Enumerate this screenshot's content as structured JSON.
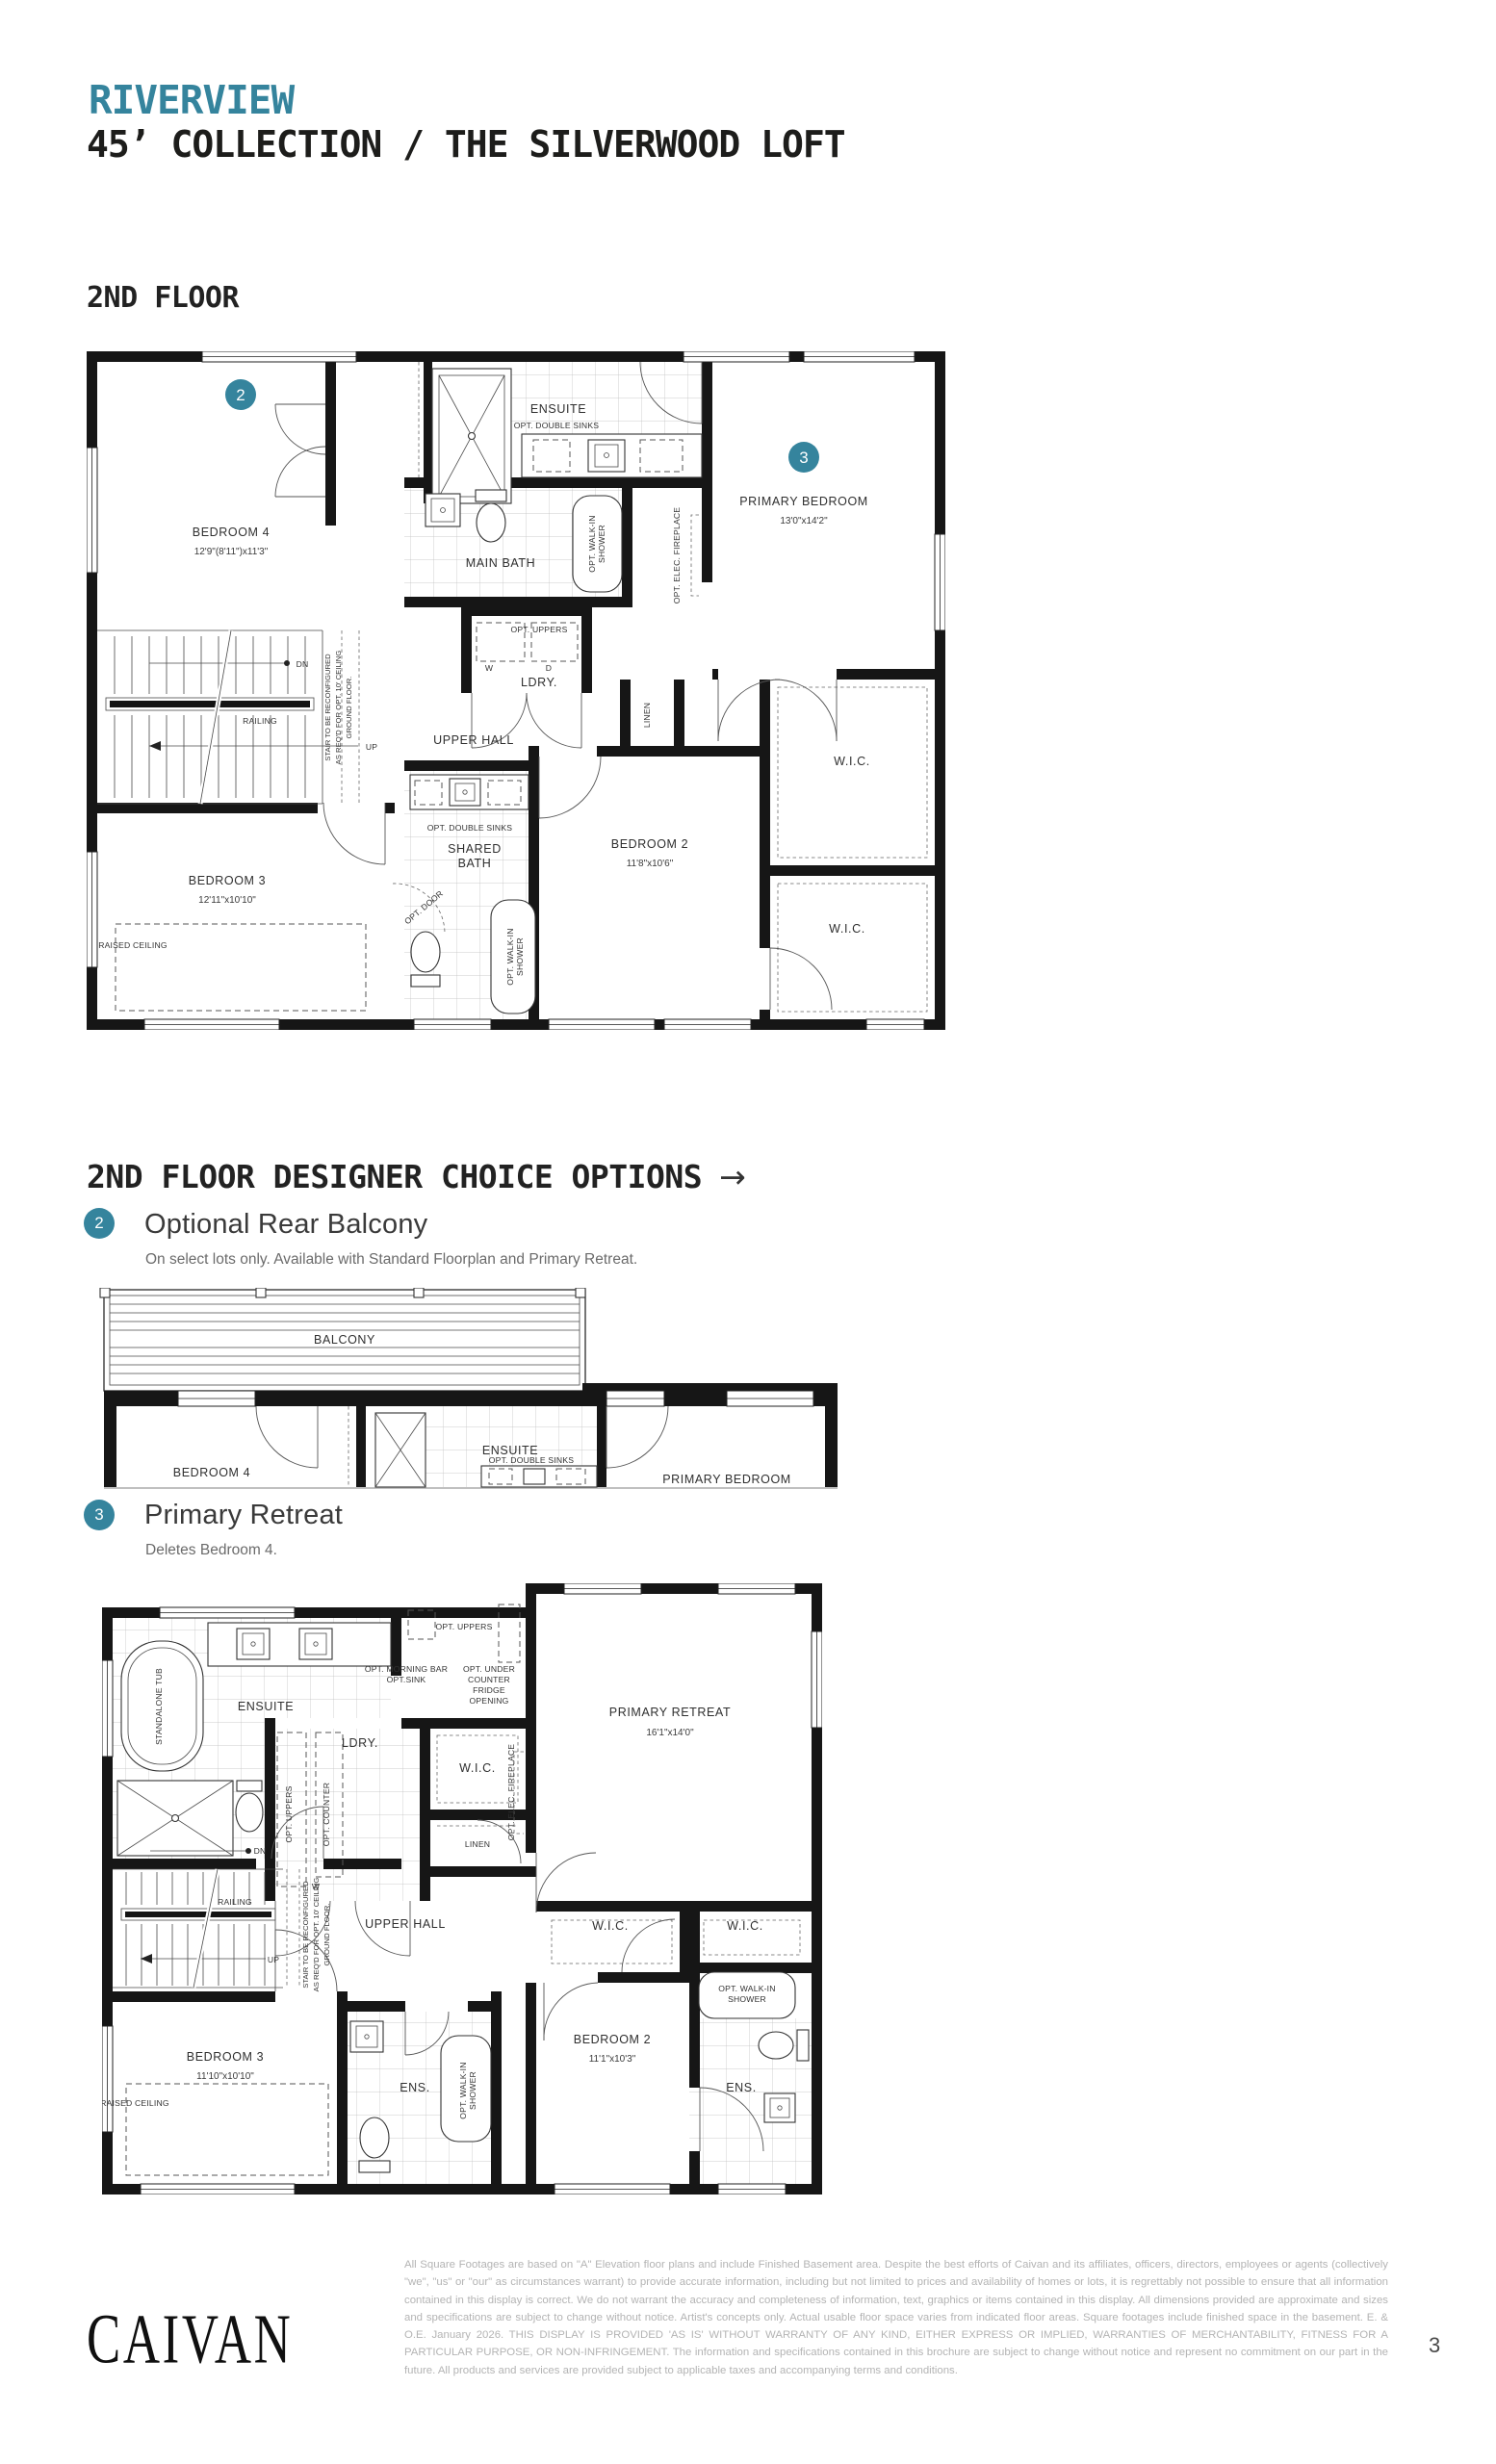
{
  "accent_color": "#35849d",
  "header": {
    "community": "RIVERVIEW",
    "title": "45’ COLLECTION / THE SILVERWOOD LOFT"
  },
  "sections": {
    "floor_heading": "2ND FLOOR",
    "options_heading": "2ND FLOOR DESIGNER CHOICE OPTIONS",
    "options_arrow": "→"
  },
  "options": [
    {
      "number": "2",
      "title": "Optional Rear Balcony",
      "description": "On select lots only. Available with Standard Floorplan and Primary Retreat."
    },
    {
      "number": "3",
      "title": "Primary Retreat",
      "description": "Deletes Bedroom 4."
    }
  ],
  "main_plan": {
    "marker2": "2",
    "marker3": "3",
    "bedroom4": {
      "name": "BEDROOM 4",
      "dims": "12'9\"(8'11\")x11'3\""
    },
    "ensuite": "ENSUITE",
    "opt_double_sinks": "OPT. DOUBLE SINKS",
    "main_bath": "MAIN BATH",
    "opt_walkin_shower_lines": [
      "OPT. WALK-IN",
      "SHOWER"
    ],
    "primary_bedroom": {
      "name": "PRIMARY BEDROOM",
      "dims": "13'0\"x14'2\""
    },
    "opt_elec_fireplace": "OPT. ELEC. FIREPLACE",
    "opt_uppers": "OPT. UPPERS",
    "w": "W",
    "d": "D",
    "ldry": "LDRY.",
    "upper_hall": "UPPER HALL",
    "dn": "DN",
    "up": "UP",
    "railing": "RAILING",
    "stair_note_lines": [
      "STAIR TO BE RECONFIGURED",
      "AS REQ'D FOR OPT. 10' CEILING",
      "GROUND FLOOR."
    ],
    "linen": "LINEN",
    "wic1": "W.I.C.",
    "wic2": "W.I.C.",
    "bedroom3": {
      "name": "BEDROOM 3",
      "dims": "12'11\"x10'10\""
    },
    "raised_ceiling": "RAISED CEILING",
    "shared_bath_lines": [
      "SHARED",
      "BATH"
    ],
    "opt_door": "OPT. DOOR",
    "bedroom2": {
      "name": "BEDROOM 2",
      "dims": "11'8\"x10'6\""
    }
  },
  "balcony_plan": {
    "balcony": "BALCONY",
    "bedroom4": "BEDROOM 4",
    "ensuite": "ENSUITE",
    "opt_double_sinks": "OPT. DOUBLE SINKS",
    "primary_bedroom": "PRIMARY BEDROOM"
  },
  "retreat_plan": {
    "standalone_tub": "STANDALONE TUB",
    "ensuite": "ENSUITE",
    "opt_uppers": "OPT. UPPERS",
    "morning_bar_lines": [
      "OPT. MORNING BAR",
      "OPT.SINK"
    ],
    "fridge_lines": [
      "OPT. UNDER",
      "COUNTER",
      "FRIDGE",
      "OPENING"
    ],
    "ldry": "LDRY.",
    "opt_uppers_v": "OPT. UPPERS",
    "opt_counter": "OPT. COUNTER",
    "w": "W",
    "wic_top": "W.I.C.",
    "linen": "LINEN",
    "primary_retreat": {
      "name": "PRIMARY RETREAT",
      "dims": "16'1\"x14'0\""
    },
    "opt_elec_fireplace": "OPT. ELEC. FIREPLACE",
    "railing": "RAILING",
    "up": "UP",
    "dn": "DN",
    "stair_note_lines": [
      "STAIR TO BE RECONFIGURED",
      "AS REQ'D FOR OPT. 10' CEILING",
      "GROUND FLOOR."
    ],
    "upper_hall": "UPPER HALL",
    "wic_a": "W.I.C.",
    "wic_b": "W.I.C.",
    "bedroom3": {
      "name": "BEDROOM 3",
      "dims": "11'10\"x10'10\""
    },
    "raised_ceiling": "RAISED CEILING",
    "ens1": "ENS.",
    "opt_walkin_shower_lines": [
      "OPT. WALK-IN",
      "SHOWER"
    ],
    "bedroom2": {
      "name": "BEDROOM 2",
      "dims": "11'1\"x10'3\""
    },
    "ens2": "ENS."
  },
  "footer": {
    "logo": "CAIVAN",
    "disclaimer": "All Square Footages are based on \"A\" Elevation floor plans and include Finished Basement area. Despite the best efforts of Caivan and its affiliates, officers, directors, employees or agents (collectively \"we\", \"us\" or \"our\" as circumstances warrant) to provide accurate information, including but not limited to prices and availability of homes or lots, it is regrettably not possible to ensure that all information contained in this display is correct. We do not warrant the accuracy and completeness of information, text, graphics or items contained in this display. All dimensions provided are approximate and sizes and specifications are subject to change without notice. Artist's concepts only. Actual usable floor space varies from indicated floor areas. Square footages include finished space in the basement. E. & O.E. January 2026. THIS DISPLAY IS PROVIDED 'AS IS' WITHOUT WARRANTY OF ANY KIND, EITHER EXPRESS OR IMPLIED, WARRANTIES OF MERCHANTABILITY, FITNESS FOR A PARTICULAR PURPOSE, OR NON-INFRINGEMENT. The information and specifications contained in this brochure are subject to change without notice and represent no commitment on our part in the future. All products and services are provided subject to applicable taxes and accompanying terms and conditions.",
    "page_number": "3"
  }
}
